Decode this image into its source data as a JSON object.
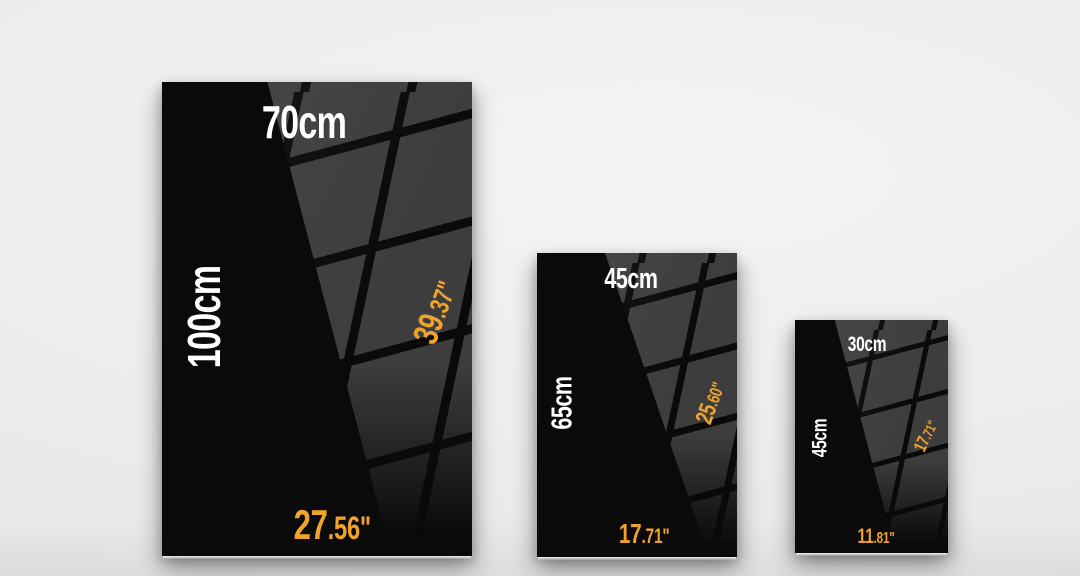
{
  "colors": {
    "wall": "#ededee",
    "poster_black": "#0a0a0b",
    "reflection_gray": "#3d3d3e",
    "cm_label": "#ffffff",
    "inch_label": "#f0a32b"
  },
  "posters": [
    {
      "width_cm": "70cm",
      "height_cm": "100cm",
      "height_in_whole": "39",
      "height_in_fraction": ".37\"",
      "width_in_whole": "27",
      "width_in_fraction": ".56\""
    },
    {
      "width_cm": "45cm",
      "height_cm": "65cm",
      "height_in_whole": "25",
      "height_in_fraction": ".60\"",
      "width_in_whole": "17",
      "width_in_fraction": ".71\""
    },
    {
      "width_cm": "30cm",
      "height_cm": "45cm",
      "height_in_whole": "17",
      "height_in_fraction": ".71\"",
      "width_in_whole": "11",
      "width_in_fraction": ".81\""
    }
  ]
}
